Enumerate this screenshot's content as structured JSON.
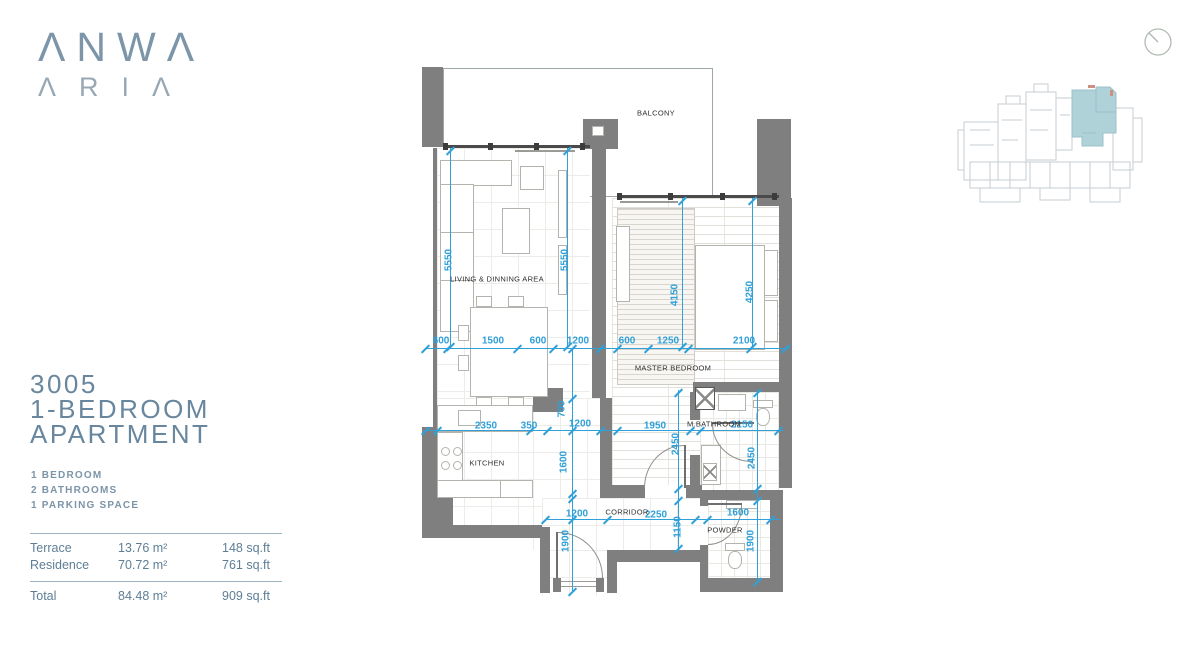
{
  "brand": {
    "line1": "ΛNWΛ",
    "line2": "ΛRIΛ"
  },
  "unit": {
    "number": "3005",
    "type_line1": "1-BEDROOM",
    "type_line2": "APARTMENT"
  },
  "features": [
    "1 BEDROOM",
    "2 BATHROOMS",
    "1 PARKING SPACE"
  ],
  "area_table": {
    "rows": [
      {
        "label": "Terrace",
        "sqm": "13.76 m²",
        "sqft": "148 sq.ft"
      },
      {
        "label": "Residence",
        "sqm": "70.72 m²",
        "sqft": "761 sq.ft"
      }
    ],
    "total": {
      "label": "Total",
      "sqm": "84.48 m²",
      "sqft": "909 sq.ft"
    }
  },
  "plan": {
    "room_labels": [
      {
        "text": "BALCONY",
        "x": 236,
        "y": 53
      },
      {
        "text": "LIVING & DINNING AREA",
        "x": 77,
        "y": 219
      },
      {
        "text": "MASTER BEDROOM",
        "x": 253,
        "y": 308
      },
      {
        "text": "KITCHEN",
        "x": 67,
        "y": 403
      },
      {
        "text": "M.BATHROOM",
        "x": 294,
        "y": 364
      },
      {
        "text": "CORRIDOR",
        "x": 207,
        "y": 452
      },
      {
        "text": "POWDER",
        "x": 305,
        "y": 470
      }
    ],
    "dimension_labels": [
      {
        "text": "5550",
        "x": 29,
        "y": 200,
        "rot": true
      },
      {
        "text": "5550",
        "x": 145,
        "y": 200,
        "rot": true
      },
      {
        "text": "4150",
        "x": 255,
        "y": 235,
        "rot": true
      },
      {
        "text": "4250",
        "x": 330,
        "y": 232,
        "rot": true
      },
      {
        "text": "600",
        "x": 21,
        "y": 281,
        "rot": false
      },
      {
        "text": "1500",
        "x": 73,
        "y": 281,
        "rot": false
      },
      {
        "text": "600",
        "x": 118,
        "y": 281,
        "rot": false
      },
      {
        "text": "1200",
        "x": 158,
        "y": 281,
        "rot": false
      },
      {
        "text": "600",
        "x": 207,
        "y": 281,
        "rot": false
      },
      {
        "text": "1250",
        "x": 248,
        "y": 281,
        "rot": false
      },
      {
        "text": "2100",
        "x": 324,
        "y": 281,
        "rot": false
      },
      {
        "text": "2350",
        "x": 66,
        "y": 366,
        "rot": false
      },
      {
        "text": "350",
        "x": 109,
        "y": 366,
        "rot": false
      },
      {
        "text": "1200",
        "x": 160,
        "y": 364,
        "rot": false
      },
      {
        "text": "1950",
        "x": 235,
        "y": 366,
        "rot": false
      },
      {
        "text": "2150",
        "x": 322,
        "y": 365,
        "rot": false
      },
      {
        "text": "700",
        "x": 142,
        "y": 349,
        "rot": true
      },
      {
        "text": "1600",
        "x": 144,
        "y": 402,
        "rot": true
      },
      {
        "text": "2450",
        "x": 256,
        "y": 384,
        "rot": true
      },
      {
        "text": "2450",
        "x": 332,
        "y": 398,
        "rot": true
      },
      {
        "text": "1200",
        "x": 157,
        "y": 454,
        "rot": false
      },
      {
        "text": "2250",
        "x": 236,
        "y": 455,
        "rot": false
      },
      {
        "text": "1600",
        "x": 318,
        "y": 453,
        "rot": false
      },
      {
        "text": "1150",
        "x": 258,
        "y": 467,
        "rot": true
      },
      {
        "text": "1900",
        "x": 146,
        "y": 481,
        "rot": true
      },
      {
        "text": "1900",
        "x": 331,
        "y": 481,
        "rot": true
      }
    ],
    "colors": {
      "wall": "#7f7f7f",
      "dimension": "#2fa0d8",
      "brand": "#7c95a8",
      "keyplan_highlight": "#aed2d8"
    }
  }
}
